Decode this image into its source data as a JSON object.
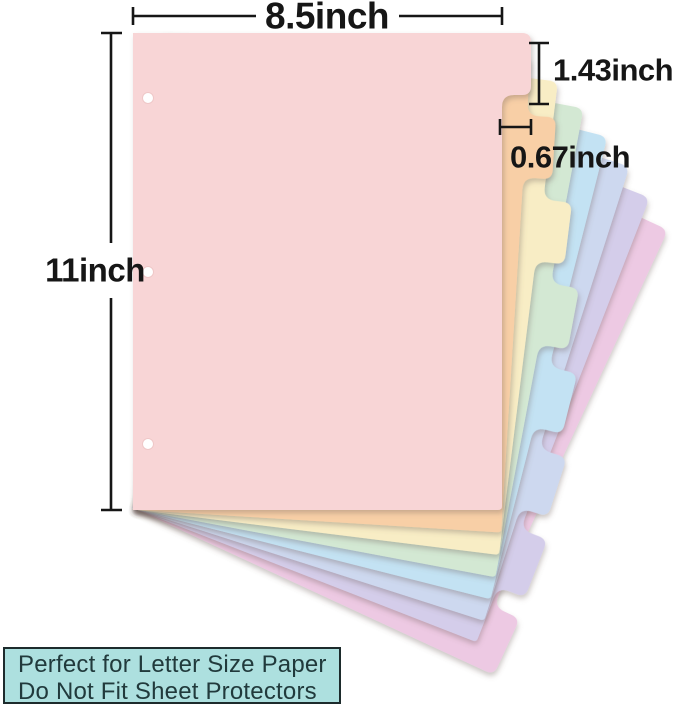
{
  "dimensions": {
    "sheet_width": "8.5inch",
    "sheet_height": "11inch",
    "tab_height": "1.43inch",
    "tab_width": "0.67inch"
  },
  "note_box": {
    "line1": "Perfect for Letter Size Paper",
    "line2": "Do Not Fit Sheet Protectors",
    "background": "#ade0df",
    "border_color": "#1d2b2c",
    "text_color": "#213a3c"
  },
  "sheets": [
    {
      "name": "pink",
      "color": "#f8d5d6"
    },
    {
      "name": "peach",
      "color": "#f8cfa6"
    },
    {
      "name": "cream",
      "color": "#f8edc5"
    },
    {
      "name": "mint",
      "color": "#d3e8d3"
    },
    {
      "name": "sky-blue",
      "color": "#c3e2f3"
    },
    {
      "name": "periwinkle",
      "color": "#cdd8ef"
    },
    {
      "name": "lavender",
      "color": "#d4cdea"
    },
    {
      "name": "orchid",
      "color": "#edc9e3"
    }
  ],
  "annotation_color": "#161616",
  "background": "#ffffff"
}
